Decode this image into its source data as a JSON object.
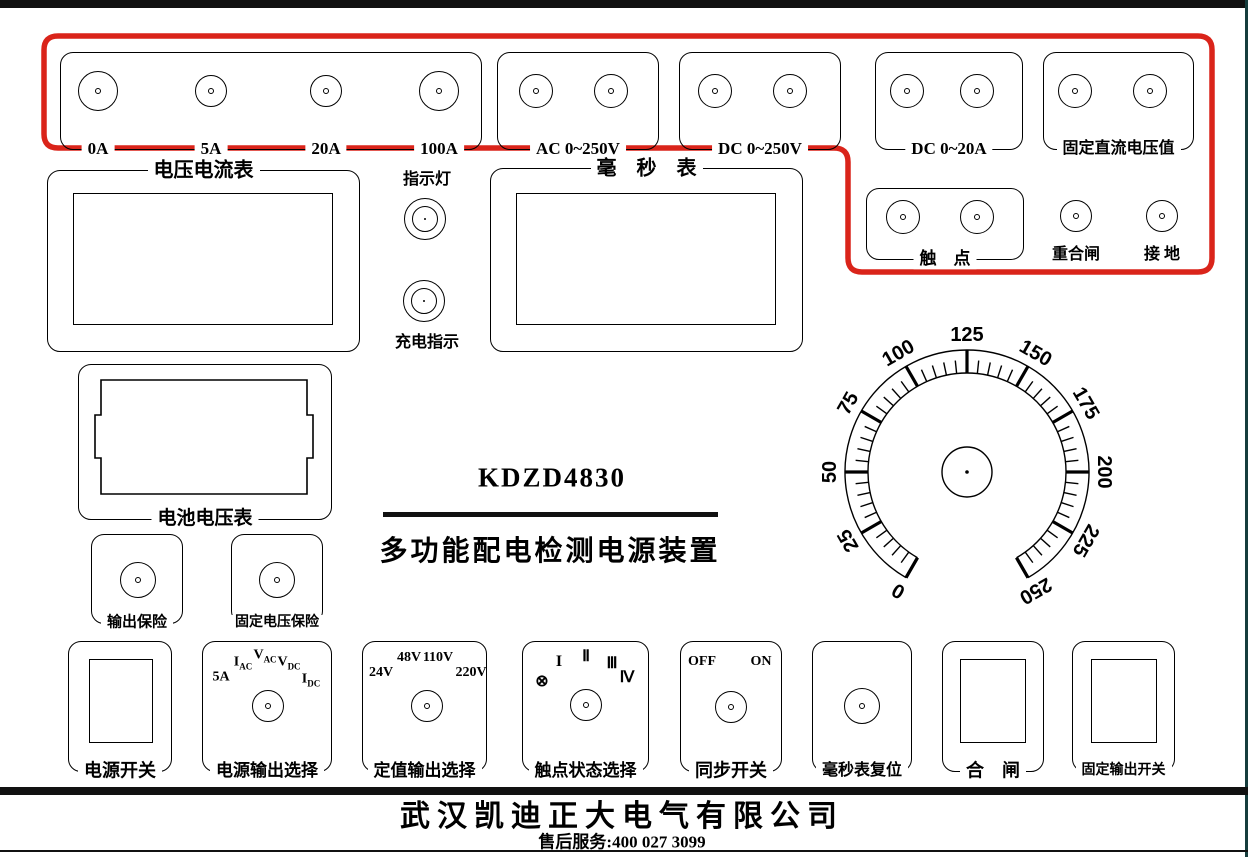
{
  "panel": {
    "model": "KDZD4830",
    "subtitle": "多功能配电检测电源装置",
    "company": "武汉凯迪正大电气有限公司",
    "service_line": "售后服务:400 027 3099",
    "accent_red": "#da241a"
  },
  "terminals": {
    "current_group": {
      "labels": [
        "0A",
        "5A",
        "20A",
        "100A"
      ]
    },
    "ac_voltage_group": {
      "label": "AC 0~250V"
    },
    "dc_voltage_group": {
      "label": "DC 0~250V"
    },
    "dc_current_group": {
      "label": "DC 0~20A"
    },
    "fixed_dc_group": {
      "label": "固定直流电压值"
    },
    "contact_group": {
      "label": "触　点"
    },
    "reclose_label": "重合闸",
    "ground_label": "接 地"
  },
  "meters": {
    "volt_ammeter_label": "电压电流表",
    "millisecond_label": "毫　秒　表",
    "battery_label": "电池电压表"
  },
  "indicators": {
    "lamp_label": "指示灯",
    "charge_label": "充电指示"
  },
  "fuses": {
    "output_label": "输出保险",
    "fixed_label": "固定电压保险"
  },
  "dial": {
    "labels": [
      "0",
      "25",
      "50",
      "75",
      "100",
      "125",
      "150",
      "175",
      "200",
      "225",
      "250"
    ],
    "max": 250,
    "major_step": 25,
    "minor_step": 5
  },
  "controls": {
    "power_switch": {
      "label": "电源开关"
    },
    "output_select": {
      "label": "电源输出选择",
      "positions": [
        {
          "pre": "5A",
          "sub": ""
        },
        {
          "pre": "I",
          "sub": "AC"
        },
        {
          "pre": "V",
          "sub": "AC"
        },
        {
          "pre": "V",
          "sub": "DC"
        },
        {
          "pre": "I",
          "sub": "DC"
        }
      ]
    },
    "setpoint_select": {
      "label": "定值输出选择",
      "positions": [
        "24V",
        "48V",
        "110V",
        "220V"
      ]
    },
    "contact_state_select": {
      "label": "触点状态选择",
      "positions": [
        "⊗",
        "I",
        "Ⅱ",
        "Ⅲ",
        "Ⅳ"
      ]
    },
    "sync_switch": {
      "label": "同步开关",
      "positions": [
        "OFF",
        "ON"
      ]
    },
    "ms_reset": {
      "label": "毫秒表复位"
    },
    "close_switch": {
      "label": "合　闸"
    },
    "fixed_output_switch": {
      "label": "固定输出开关"
    }
  }
}
